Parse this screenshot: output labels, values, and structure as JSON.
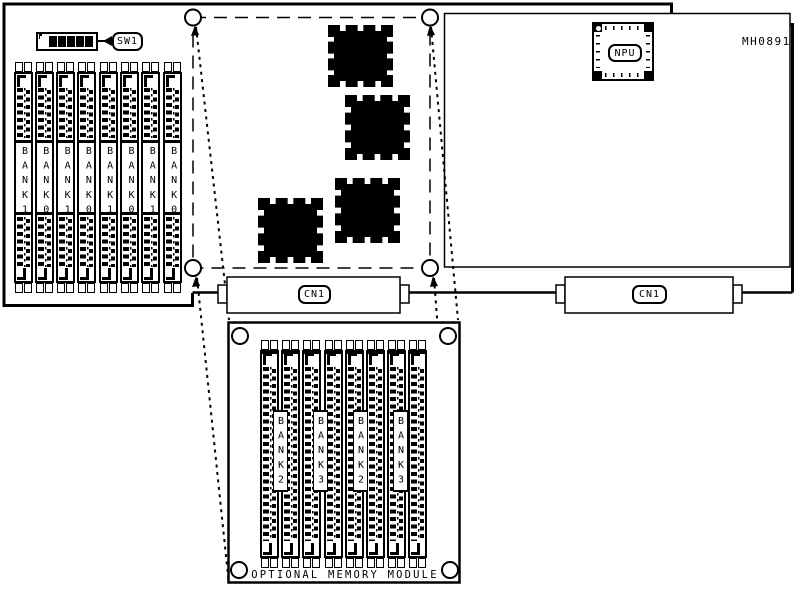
{
  "board": {
    "part_number": "MH0891",
    "dip_switch": {
      "label": "SW1",
      "cells": [
        "off",
        "on",
        "on",
        "on",
        "on",
        "on"
      ]
    },
    "npu": {
      "label": "NPU"
    },
    "connectors": [
      {
        "label": "CN1"
      },
      {
        "label": "CN1"
      }
    ],
    "memory_banks": [
      "BANK1",
      "BANK0",
      "BANK1",
      "BANK0",
      "BANK1",
      "BANK0",
      "BANK1",
      "BANK0"
    ]
  },
  "optional_module": {
    "label": "OPTIONAL MEMORY MODULE",
    "slot_count": 8,
    "memory_banks": [
      "BANK2",
      "BANK3",
      "BANK2",
      "BANK3"
    ]
  },
  "colors": {
    "line": "#000000",
    "background": "#ffffff"
  }
}
